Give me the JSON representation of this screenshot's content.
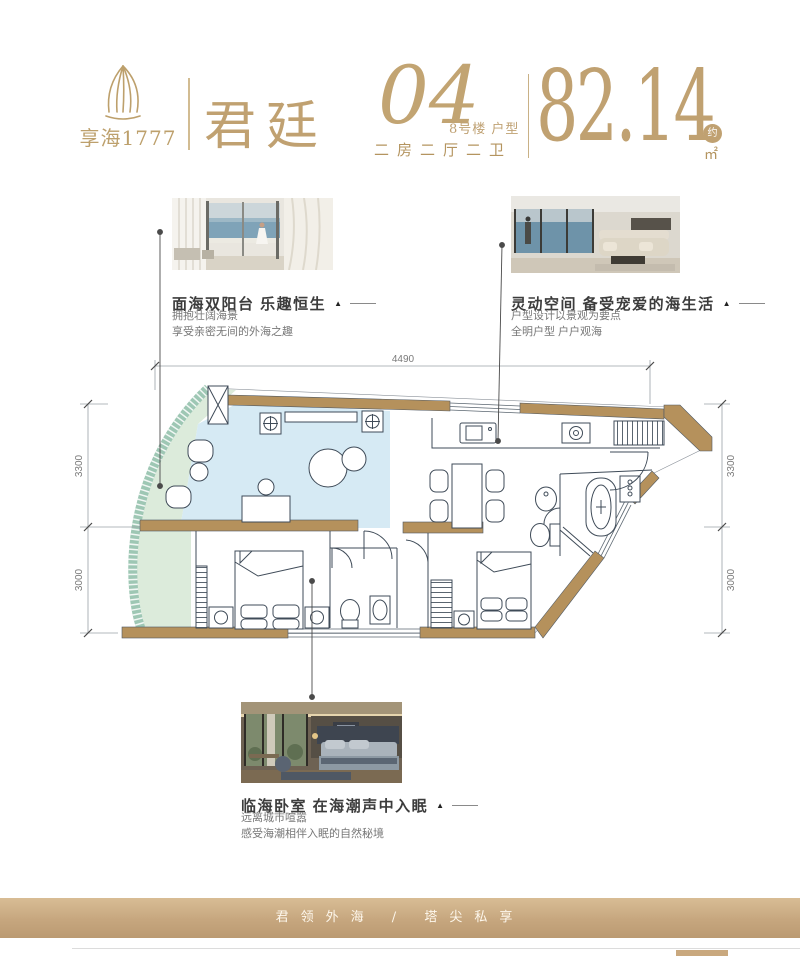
{
  "brand": {
    "logo_name": "享海1777",
    "product_name": "君廷"
  },
  "unit": {
    "number": "04",
    "building": "8号楼",
    "type_label": "户型",
    "layout": "二房二厅二卫",
    "area": "82.14",
    "approx": "约",
    "area_unit": "㎡"
  },
  "features": [
    {
      "title": "面海双阳台 乐趣恒生",
      "line1": "拥抱壮阔海景",
      "line2": "享受亲密无间的外海之趣"
    },
    {
      "title": "灵动空间 备受宠爱的海生活",
      "line1": "户型设计以景观为要点",
      "line2": "全明户型 户户观海"
    },
    {
      "title": "临海卧室 在海潮声中入眠",
      "line1": "远离城市喧嚣",
      "line2": "感受海潮相伴入眠的自然秘境"
    }
  ],
  "floorplan": {
    "dims": {
      "top": "4490",
      "left": [
        "3300",
        "3000"
      ],
      "right": [
        "3300",
        "3000"
      ]
    }
  },
  "footer": {
    "slogan": "君领外海 / 塔尖私享"
  },
  "ui": {
    "marker": "▲"
  },
  "colors": {
    "brand_gold": "#c0a171",
    "wall_tan": "#b5915c",
    "balcony_green": "#dcebdb",
    "living_blue": "#cfe6f2",
    "band_tan": "#c6a67e"
  }
}
